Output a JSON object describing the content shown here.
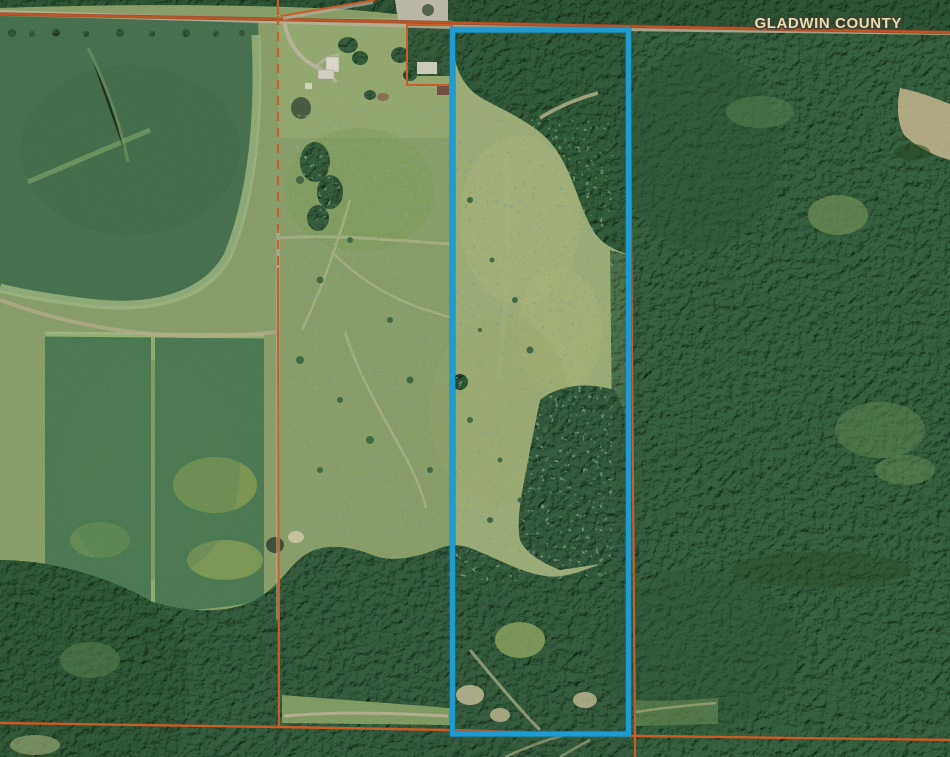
{
  "map": {
    "county_label": "GLADWIN COUNTY",
    "colors": {
      "parcel_outline": "#1E9CCF",
      "boundary_line": "#C75E28",
      "county_line": "#BE5526",
      "label_fill": "#EBDCAE",
      "label_outline": "#3F4236",
      "road": "#B9B096",
      "water": "#45543E"
    },
    "terrain_palette": {
      "field_dark": "#42684A",
      "field_lower": "#46704D",
      "pasture_scrub": "#7F9560",
      "parcel_pasture": "#94A56D",
      "forest": "#2F5536",
      "forest_dense": "#2C5033",
      "forest_light": "#4A7348",
      "clearing_tan": "#B4AB85"
    }
  }
}
